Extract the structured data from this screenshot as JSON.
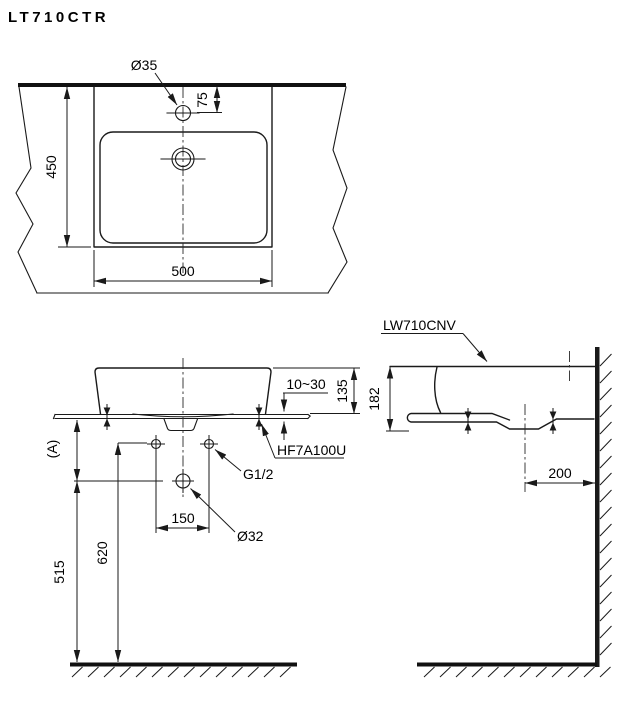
{
  "title": "LT710CTR",
  "colors": {
    "line": "#1a1a1a",
    "text": "#000000",
    "background": "#ffffff"
  },
  "top_view": {
    "hole_diameter": "Ø35",
    "hole_offset": "75",
    "depth": "450",
    "width": "500"
  },
  "front_view": {
    "counter_thickness": "10~30",
    "rim_to_counter": "135",
    "fixing_bolt": "HF7A100U",
    "supply_thread": "G1/2",
    "supply_spread": "150",
    "drain_diameter": "Ø32",
    "ref_a": "(A)",
    "drain_height": "515",
    "supply_height": "620"
  },
  "side_view": {
    "counter_model": "LW710CNV",
    "height": "182",
    "drain_to_wall": "200"
  }
}
